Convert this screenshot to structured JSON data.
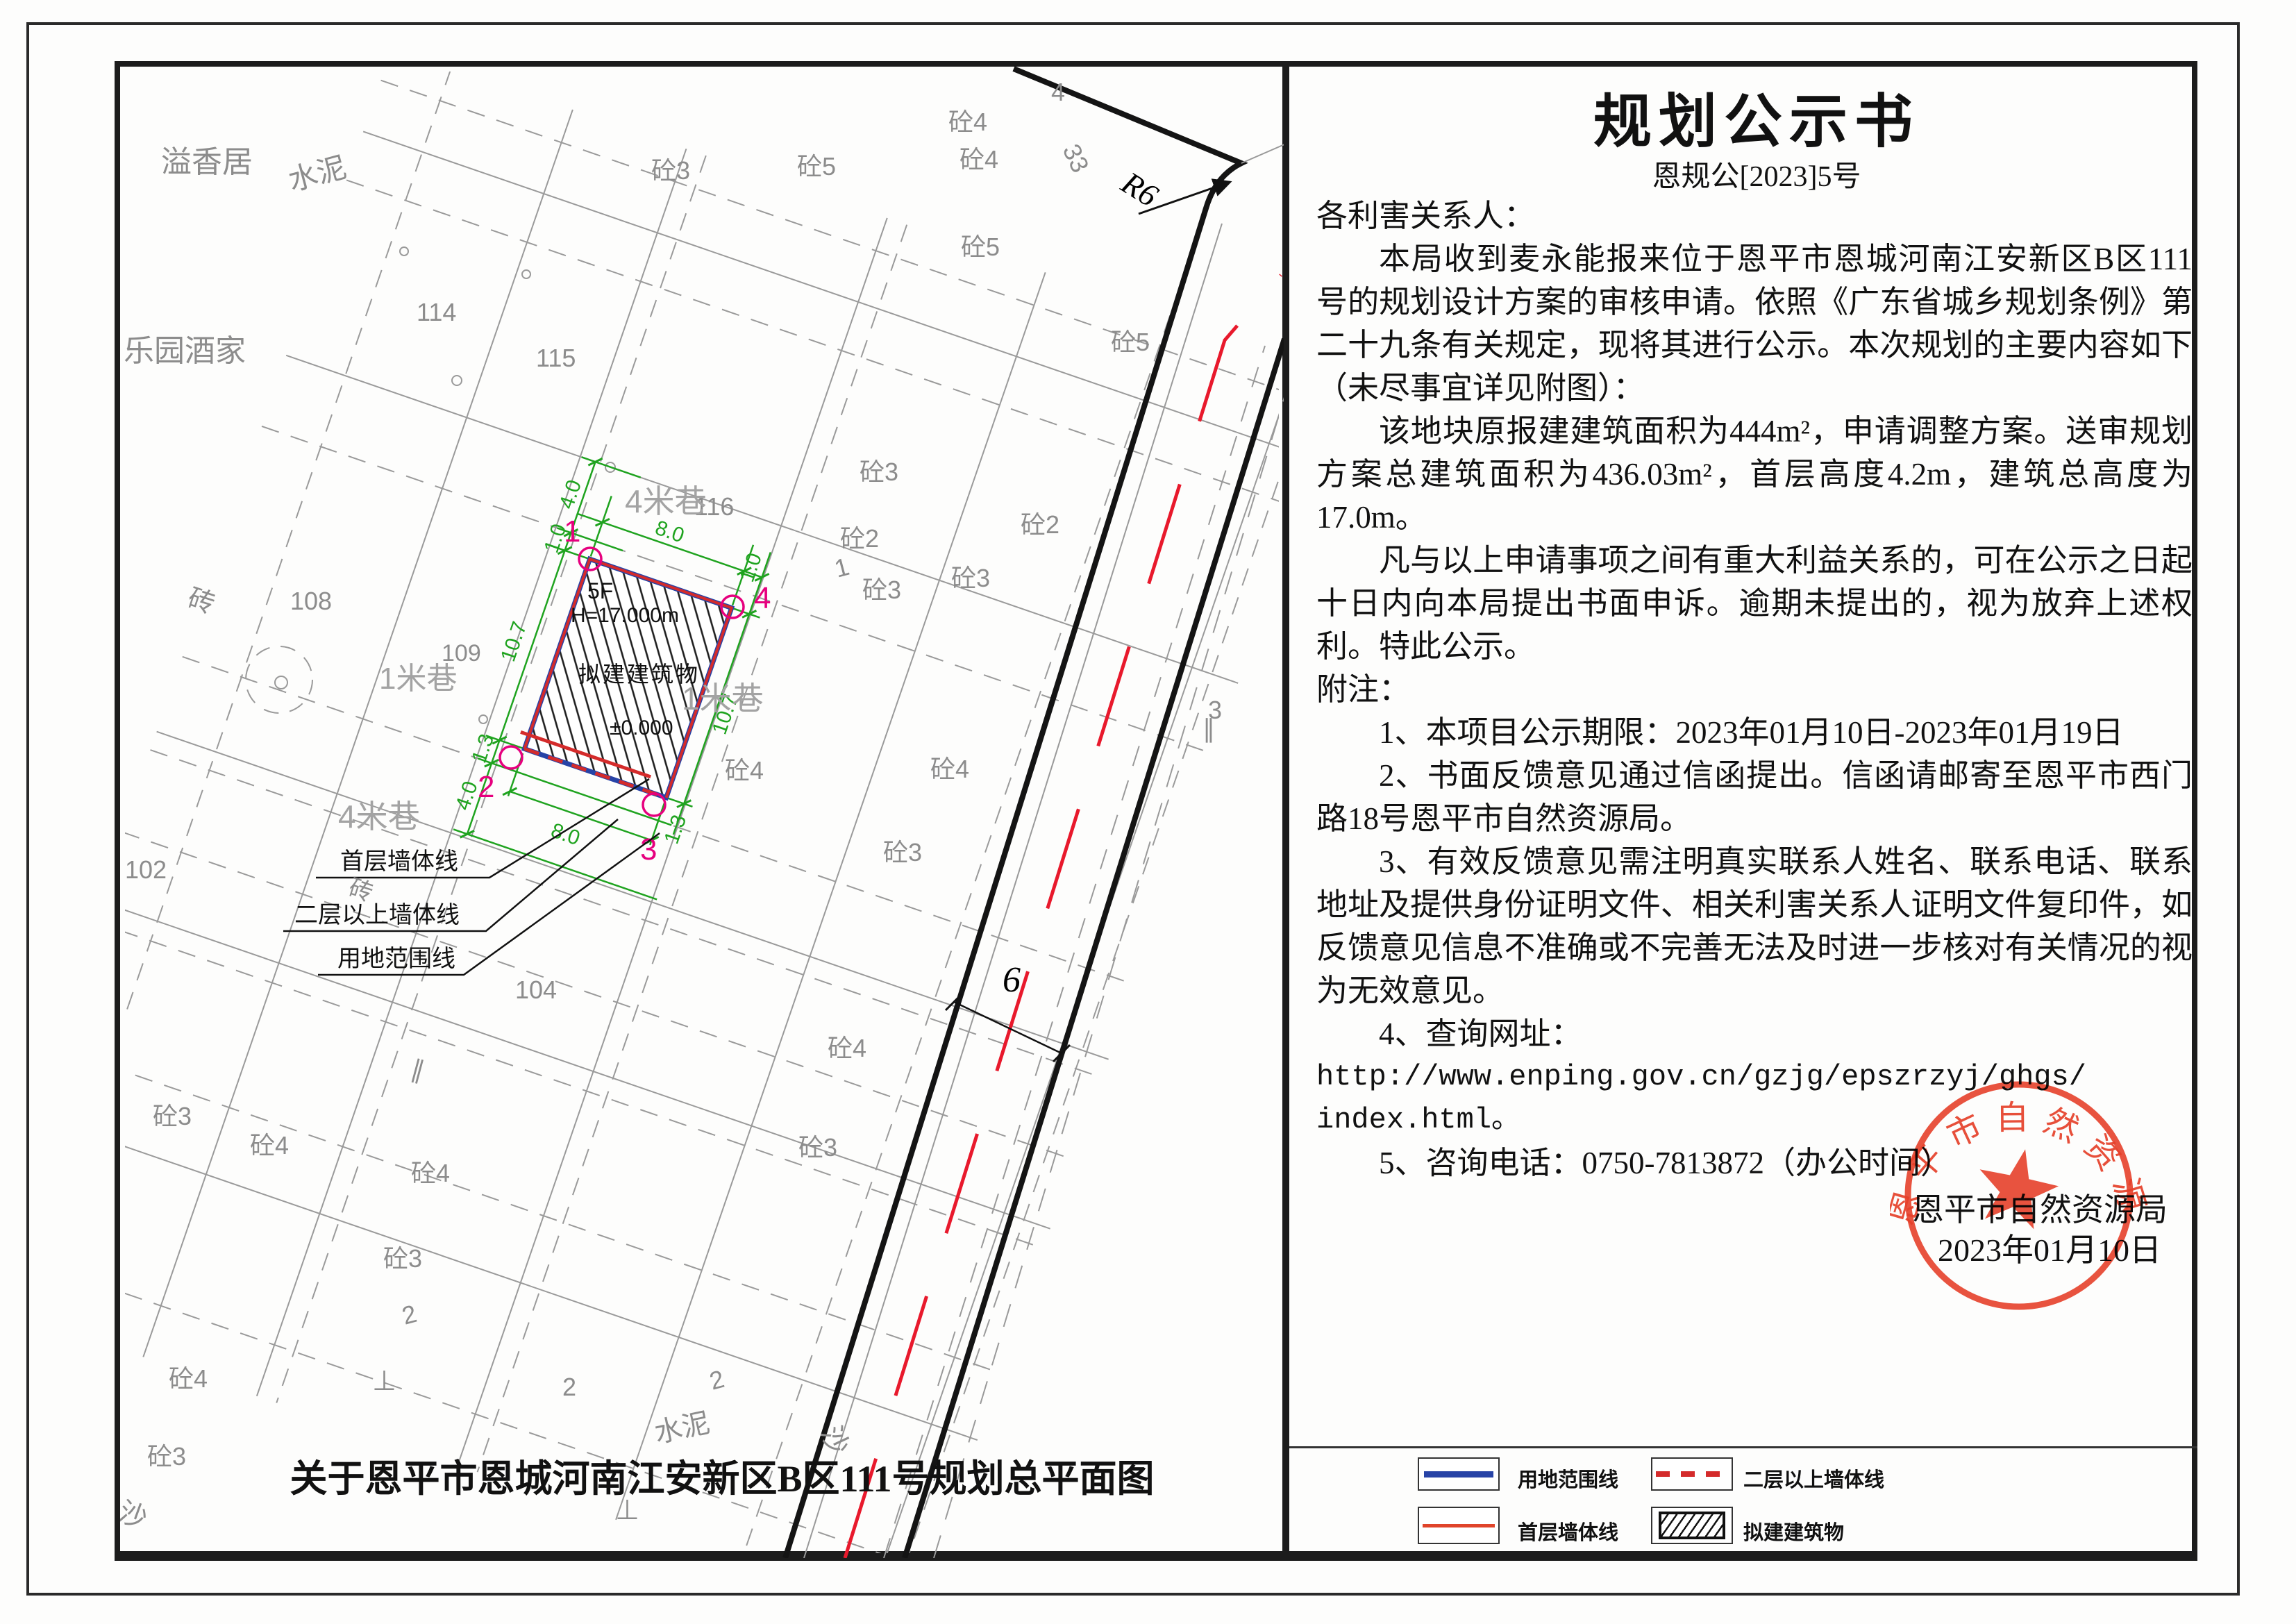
{
  "document": {
    "title": "规划公示书",
    "doc_no": "恩规公[2023]5号",
    "salutation": "各利害关系人：",
    "p1": "本局收到麦永能报来位于恩平市恩城河南江安新区B区111号的规划设计方案的审核申请。依照《广东省城乡规划条例》第二十九条有关规定，现将其进行公示。本次规划的主要内容如下（未尽事宜详见附图）：",
    "p2": "该地块原报建建筑面积为444m²，申请调整方案。送审规划方案总建筑面积为436.03m²，首层高度4.2m，建筑总高度为17.0m。",
    "p3": "凡与以上申请事项之间有重大利益关系的，可在公示之日起十日内向本局提出书面申诉。逾期未提出的，视为放弃上述权利。特此公示。",
    "notes_label": "附注：",
    "note1": "1、本项目公示期限：2023年01月10日-2023年01月19日",
    "note2": "2、书面反馈意见通过信函提出。信函请邮寄至恩平市西门路18号恩平市自然资源局。",
    "note3": "3、有效反馈意见需注明真实联系人姓名、联系电话、联系地址及提供身份证明文件、相关利害关系人证明文件复印件，如反馈意见信息不准确或不完善无法及时进一步核对有关情况的视为无效意见。",
    "note4_label": "4、查询网址：",
    "url_line1": "http://www.enping.gov.cn/gzjg/epszrzyj/ghgs/",
    "url_line2": "index.html。",
    "note5": "5、咨询电话：0750-7813872（办公时间）",
    "agency": "恩平市自然资源局",
    "date": "2023年01月10日",
    "stamp_text": "恩平市自然资源局"
  },
  "map": {
    "caption": "关于恩平市恩城河南江安新区B区111号规划总平面图",
    "building": {
      "floors": "5F",
      "height": "H=17.000m",
      "name": "拟建建筑物",
      "level_zero": "±0.000",
      "corners": [
        "1",
        "2",
        "3",
        "4"
      ]
    },
    "dims": {
      "d40a": "4.0",
      "d10a": "1.0",
      "d80top": "8.0",
      "d10b": "1.0",
      "d107l": "10.7",
      "d13l": "1.3",
      "d40b": "4.0",
      "d107r": "10.7",
      "d80bot": "8.0",
      "d13r": "1.3",
      "road_width": "6",
      "radius": "R6"
    },
    "leaders": {
      "first_floor_wall": "首层墙体线",
      "upper_floor_wall": "二层以上墙体线",
      "land_boundary": "用地范围线"
    },
    "labels": [
      {
        "text": "溢香居"
      },
      {
        "text": "水泥"
      },
      {
        "text": "乐园酒家"
      },
      {
        "text": "114"
      },
      {
        "text": "115"
      },
      {
        "text": "116"
      },
      {
        "text": "108"
      },
      {
        "text": "109"
      },
      {
        "text": "102"
      },
      {
        "text": "104"
      },
      {
        "text": "砖"
      },
      {
        "text": "砖"
      },
      {
        "text": "4米巷"
      },
      {
        "text": "4米巷"
      },
      {
        "text": "1米巷"
      },
      {
        "text": "1米巷"
      },
      {
        "text": "砼3"
      },
      {
        "text": "砼5"
      },
      {
        "text": "砼4"
      },
      {
        "text": "砼4"
      },
      {
        "text": "砼5"
      },
      {
        "text": "砼5"
      },
      {
        "text": "砼3"
      },
      {
        "text": "砼2"
      },
      {
        "text": "砼2"
      },
      {
        "text": "砼3"
      },
      {
        "text": "砼3"
      },
      {
        "text": "砼4"
      },
      {
        "text": "砼4"
      },
      {
        "text": "砼3"
      },
      {
        "text": "砼4"
      },
      {
        "text": "砼3"
      },
      {
        "text": "砼3"
      },
      {
        "text": "砼4"
      },
      {
        "text": "砼4"
      },
      {
        "text": "砼3"
      },
      {
        "text": "砼4"
      },
      {
        "text": "砼3"
      },
      {
        "text": "沙"
      },
      {
        "text": "沙"
      },
      {
        "text": "水泥"
      },
      {
        "text": "2"
      },
      {
        "text": "2"
      },
      {
        "text": "2"
      },
      {
        "text": "1"
      },
      {
        "text": "3"
      },
      {
        "text": "4"
      },
      {
        "text": "33"
      },
      {
        "text": "⊥"
      },
      {
        "text": "⊥"
      },
      {
        "text": "∥"
      },
      {
        "text": "∥"
      }
    ]
  },
  "legend": {
    "items": [
      {
        "label": "用地范围线"
      },
      {
        "label": "二层以上墙体线"
      },
      {
        "label": "首层墙体线"
      },
      {
        "label": "拟建建筑物"
      }
    ]
  },
  "colors": {
    "land_boundary_blue": "#2743a6",
    "wall_red": "#d42b2b",
    "dim_green": "#1fa31f",
    "corner_magenta": "#e6007e",
    "road_center_red": "#e8192c",
    "stamp_red": "#e8402a"
  }
}
